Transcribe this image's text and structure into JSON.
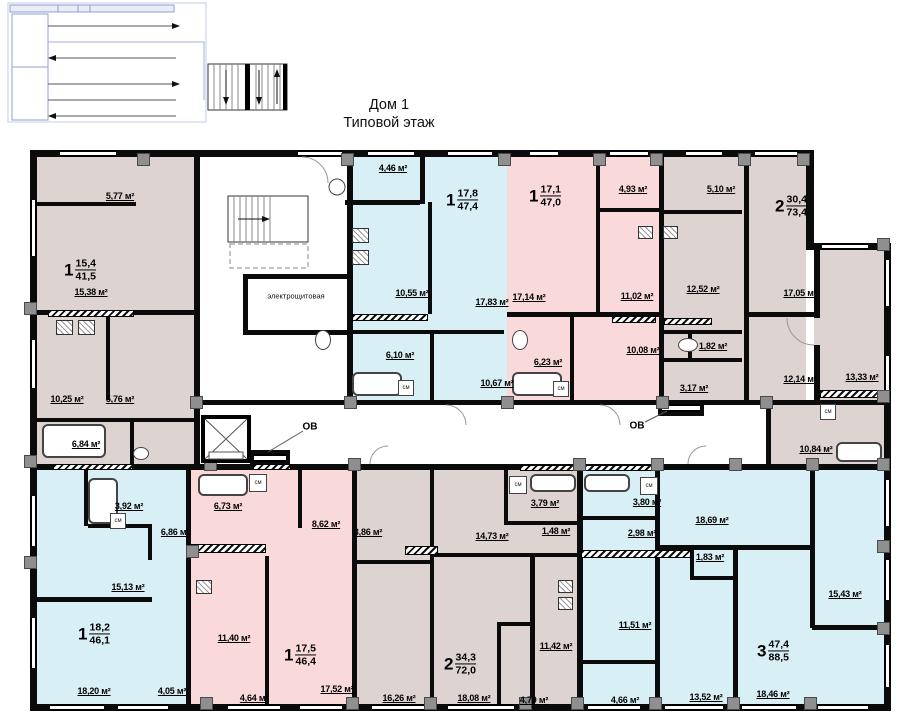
{
  "title": {
    "line1": "Дом 1",
    "line2": "Типовой этаж"
  },
  "colors": {
    "beige": "#ddd3d1",
    "pink": "#f9d9da",
    "blue": "#d9eff6",
    "wall": "#0b0b0b",
    "pilaster": "#8f8f8f",
    "schematic_line": "#8fa0cc"
  },
  "plan": {
    "rooms": [
      [
        36,
        156,
        158,
        308,
        "beige"
      ],
      [
        663,
        156,
        143,
        248,
        "beige"
      ],
      [
        814,
        250,
        70,
        156,
        "beige"
      ],
      [
        766,
        404,
        118,
        60,
        "beige"
      ],
      [
        356,
        470,
        222,
        234,
        "beige"
      ],
      [
        507,
        156,
        155,
        248,
        "pink"
      ],
      [
        188,
        470,
        167,
        234,
        "pink"
      ],
      [
        350,
        156,
        157,
        248,
        "blue"
      ],
      [
        36,
        470,
        152,
        234,
        "blue"
      ],
      [
        581,
        470,
        303,
        234,
        "blue"
      ]
    ],
    "ext_walls": [
      [
        30,
        150,
        783,
        7
      ],
      [
        30,
        150,
        7,
        561
      ],
      [
        30,
        704,
        861,
        7
      ],
      [
        884,
        243,
        7,
        468
      ],
      [
        806,
        150,
        8,
        100
      ],
      [
        806,
        243,
        85,
        7
      ]
    ],
    "walls": [
      [
        36,
        202,
        100,
        4
      ],
      [
        36,
        310,
        158,
        5
      ],
      [
        106,
        314,
        4,
        86
      ],
      [
        36,
        418,
        158,
        4
      ],
      [
        130,
        422,
        4,
        42
      ],
      [
        194,
        150,
        6,
        320
      ],
      [
        243,
        274,
        110,
        5
      ],
      [
        243,
        279,
        5,
        51
      ],
      [
        243,
        330,
        110,
        5
      ],
      [
        347,
        150,
        6,
        254
      ],
      [
        345,
        200,
        75,
        5
      ],
      [
        420,
        156,
        5,
        48
      ],
      [
        350,
        314,
        78,
        5
      ],
      [
        350,
        330,
        154,
        4
      ],
      [
        428,
        202,
        4,
        112
      ],
      [
        430,
        334,
        4,
        70
      ],
      [
        596,
        156,
        4,
        156
      ],
      [
        596,
        208,
        63,
        4
      ],
      [
        507,
        312,
        152,
        5
      ],
      [
        570,
        316,
        4,
        88
      ],
      [
        659,
        150,
        5,
        254
      ],
      [
        663,
        210,
        79,
        4
      ],
      [
        663,
        330,
        79,
        4
      ],
      [
        688,
        334,
        4,
        24
      ],
      [
        663,
        358,
        79,
        4
      ],
      [
        744,
        150,
        5,
        254
      ],
      [
        747,
        312,
        67,
        5
      ],
      [
        814,
        250,
        6,
        68
      ],
      [
        814,
        345,
        6,
        58
      ],
      [
        766,
        404,
        5,
        60
      ],
      [
        194,
        400,
        690,
        5
      ],
      [
        30,
        464,
        861,
        6
      ],
      [
        84,
        470,
        4,
        56
      ],
      [
        88,
        524,
        64,
        4
      ],
      [
        148,
        524,
        4,
        36
      ],
      [
        30,
        597,
        122,
        5
      ],
      [
        186,
        470,
        5,
        240
      ],
      [
        298,
        470,
        4,
        58
      ],
      [
        265,
        556,
        4,
        148
      ],
      [
        352,
        470,
        5,
        234
      ],
      [
        430,
        470,
        4,
        234
      ],
      [
        356,
        560,
        74,
        4
      ],
      [
        430,
        553,
        148,
        4
      ],
      [
        504,
        470,
        4,
        54
      ],
      [
        504,
        521,
        74,
        4
      ],
      [
        497,
        622,
        37,
        4
      ],
      [
        497,
        625,
        4,
        80
      ],
      [
        530,
        556,
        5,
        154
      ],
      [
        577,
        470,
        6,
        234
      ],
      [
        581,
        516,
        76,
        4
      ],
      [
        655,
        470,
        5,
        84
      ],
      [
        655,
        554,
        5,
        156
      ],
      [
        581,
        660,
        76,
        4
      ],
      [
        660,
        545,
        152,
        5
      ],
      [
        690,
        548,
        4,
        30
      ],
      [
        690,
        576,
        47,
        4
      ],
      [
        733,
        548,
        5,
        162
      ],
      [
        810,
        470,
        5,
        158
      ],
      [
        812,
        625,
        72,
        5
      ],
      [
        250,
        450,
        40,
        16
      ],
      [
        658,
        400,
        46,
        16
      ]
    ],
    "hatch": [
      [
        48,
        310,
        86,
        7
      ],
      [
        352,
        314,
        76,
        7
      ],
      [
        612,
        316,
        44,
        7
      ],
      [
        664,
        318,
        48,
        7
      ],
      [
        53,
        464,
        80,
        6
      ],
      [
        253,
        464,
        38,
        6
      ],
      [
        520,
        465,
        135,
        6
      ],
      [
        188,
        544,
        78,
        9
      ],
      [
        581,
        550,
        110,
        8
      ],
      [
        820,
        390,
        64,
        8
      ],
      [
        405,
        546,
        33,
        9
      ]
    ],
    "windows": [
      [
        60,
        150,
        56,
        7,
        "h"
      ],
      [
        298,
        150,
        44,
        7,
        "h"
      ],
      [
        368,
        150,
        46,
        7,
        "h"
      ],
      [
        448,
        150,
        44,
        7,
        "h"
      ],
      [
        530,
        150,
        28,
        7,
        "h"
      ],
      [
        610,
        150,
        38,
        7,
        "h"
      ],
      [
        686,
        150,
        36,
        7,
        "h"
      ],
      [
        755,
        150,
        42,
        7,
        "h"
      ],
      [
        822,
        243,
        46,
        7,
        "h"
      ],
      [
        50,
        704,
        54,
        7,
        "h"
      ],
      [
        118,
        704,
        50,
        7,
        "h"
      ],
      [
        228,
        704,
        52,
        7,
        "h"
      ],
      [
        300,
        704,
        42,
        7,
        "h"
      ],
      [
        372,
        704,
        54,
        7,
        "h"
      ],
      [
        448,
        704,
        66,
        7,
        "h"
      ],
      [
        588,
        704,
        52,
        7,
        "h"
      ],
      [
        665,
        704,
        58,
        7,
        "h"
      ],
      [
        742,
        704,
        54,
        7,
        "h"
      ],
      [
        818,
        704,
        50,
        7,
        "h"
      ],
      [
        30,
        200,
        7,
        56,
        "v"
      ],
      [
        30,
        340,
        7,
        48,
        "v"
      ],
      [
        30,
        496,
        7,
        50,
        "v"
      ],
      [
        30,
        618,
        7,
        50,
        "v"
      ],
      [
        884,
        260,
        7,
        46,
        "v"
      ],
      [
        884,
        356,
        7,
        40,
        "v"
      ],
      [
        884,
        480,
        7,
        46,
        "v"
      ],
      [
        884,
        560,
        7,
        40,
        "v"
      ],
      [
        884,
        645,
        7,
        42,
        "v"
      ],
      [
        254,
        454,
        32,
        8,
        "h"
      ],
      [
        662,
        404,
        38,
        8,
        "h"
      ]
    ],
    "pilasters": [
      [
        137,
        153
      ],
      [
        341,
        153
      ],
      [
        498,
        153
      ],
      [
        593,
        153
      ],
      [
        650,
        153
      ],
      [
        738,
        153
      ],
      [
        797,
        153
      ],
      [
        200,
        697
      ],
      [
        346,
        697
      ],
      [
        424,
        697
      ],
      [
        519,
        697
      ],
      [
        571,
        697
      ],
      [
        649,
        697
      ],
      [
        727,
        697
      ],
      [
        804,
        697
      ],
      [
        24,
        302
      ],
      [
        24,
        455
      ],
      [
        24,
        556
      ],
      [
        877,
        238
      ],
      [
        877,
        390
      ],
      [
        877,
        458
      ],
      [
        877,
        540
      ],
      [
        877,
        622
      ],
      [
        190,
        396
      ],
      [
        344,
        396
      ],
      [
        501,
        396
      ],
      [
        656,
        396
      ],
      [
        760,
        396
      ],
      [
        204,
        458
      ],
      [
        348,
        458
      ],
      [
        573,
        458
      ],
      [
        651,
        458
      ],
      [
        729,
        458
      ],
      [
        806,
        458
      ],
      [
        186,
        545
      ]
    ],
    "tubs": [
      [
        42,
        424,
        64,
        34
      ],
      [
        352,
        372,
        50,
        24
      ],
      [
        512,
        372,
        50,
        24
      ],
      [
        836,
        442,
        46,
        20
      ],
      [
        88,
        478,
        30,
        46
      ],
      [
        198,
        474,
        50,
        22
      ],
      [
        530,
        474,
        46,
        18
      ],
      [
        584,
        474,
        46,
        18
      ]
    ],
    "stoves": [
      [
        56,
        320,
        17,
        15
      ],
      [
        78,
        320,
        17,
        15
      ],
      [
        352,
        228,
        17,
        15
      ],
      [
        352,
        250,
        17,
        15
      ],
      [
        638,
        226,
        15,
        13
      ],
      [
        663,
        226,
        15,
        13
      ],
      [
        196,
        580,
        16,
        14
      ],
      [
        558,
        580,
        15,
        13
      ],
      [
        558,
        597,
        15,
        13
      ]
    ],
    "toilets": [
      [
        315,
        330,
        16,
        20
      ],
      [
        512,
        330,
        16,
        20
      ],
      [
        678,
        338,
        20,
        14
      ],
      [
        133,
        447,
        16,
        13
      ]
    ],
    "cm_label": "см",
    "cm_boxes": [
      [
        249,
        474,
        18,
        18
      ],
      [
        398,
        380,
        16,
        16
      ],
      [
        553,
        381,
        16,
        16
      ],
      [
        820,
        404,
        16,
        16
      ],
      [
        509,
        476,
        18,
        18
      ],
      [
        640,
        477,
        18,
        18
      ],
      [
        110,
        513,
        16,
        16
      ]
    ],
    "area_labels": [
      [
        120,
        196,
        "5,77 м²"
      ],
      [
        91,
        292,
        "15,38 м²"
      ],
      [
        67,
        399,
        "10,25 м²"
      ],
      [
        120,
        399,
        "5,76 м²"
      ],
      [
        86,
        444,
        "6,84 м²"
      ],
      [
        393,
        168,
        "4,46 м²"
      ],
      [
        412,
        293,
        "10,55 м²"
      ],
      [
        492,
        302,
        "17,83 м²"
      ],
      [
        400,
        355,
        "6,10 м²"
      ],
      [
        497,
        383,
        "10,67 м²"
      ],
      [
        529,
        297,
        "17,14 м²"
      ],
      [
        548,
        362,
        "6,23 м²"
      ],
      [
        633,
        189,
        "4,93 м²"
      ],
      [
        637,
        296,
        "11,02 м²"
      ],
      [
        643,
        350,
        "10,08 м²"
      ],
      [
        721,
        189,
        "5,10 м²"
      ],
      [
        703,
        289,
        "12,52 м²"
      ],
      [
        713,
        346,
        "1,82 м²"
      ],
      [
        694,
        388,
        "3,17 м²"
      ],
      [
        800,
        293,
        "17,05 м²"
      ],
      [
        800,
        379,
        "12,14 м²"
      ],
      [
        862,
        377,
        "13,33 м²"
      ],
      [
        816,
        449,
        "10,84 м²"
      ],
      [
        129,
        506,
        "3,92 м²"
      ],
      [
        175,
        532,
        "6,86 м²"
      ],
      [
        128,
        587,
        "15,13 м²"
      ],
      [
        94,
        691,
        "18,20 м²"
      ],
      [
        172,
        691,
        "4,05 м²"
      ],
      [
        228,
        506,
        "6,73 м²"
      ],
      [
        326,
        524,
        "8,62 м²"
      ],
      [
        234,
        638,
        "11,40 м²"
      ],
      [
        254,
        698,
        "4,64 м²"
      ],
      [
        337,
        689,
        "17,52 м²"
      ],
      [
        368,
        532,
        "3,86 м²"
      ],
      [
        492,
        536,
        "14,73 м²"
      ],
      [
        399,
        698,
        "16,26 м²"
      ],
      [
        474,
        698,
        "18,08 м²"
      ],
      [
        534,
        700,
        "4,79 м²"
      ],
      [
        545,
        503,
        "3,79 м²"
      ],
      [
        556,
        531,
        "1,48 м²"
      ],
      [
        556,
        646,
        "11,42 м²"
      ],
      [
        647,
        502,
        "3,80 м²"
      ],
      [
        642,
        533,
        "2,98 м²"
      ],
      [
        635,
        625,
        "11,51 м²"
      ],
      [
        625,
        700,
        "4,66 м²"
      ],
      [
        712,
        520,
        "18,69 м²"
      ],
      [
        710,
        557,
        "1,83 м²"
      ],
      [
        706,
        697,
        "13,52 м²"
      ],
      [
        773,
        694,
        "18,46 м²"
      ],
      [
        845,
        594,
        "15,43 м²"
      ]
    ],
    "apartments": [
      [
        80,
        270,
        "1",
        "15,4",
        "41,5"
      ],
      [
        462,
        200,
        "1",
        "17,8",
        "47,4"
      ],
      [
        545,
        196,
        "1",
        "17,1",
        "47,0"
      ],
      [
        791,
        206,
        "2",
        "30,4",
        "73,4"
      ],
      [
        94,
        634,
        "1",
        "18,2",
        "46,1"
      ],
      [
        300,
        655,
        "1",
        "17,5",
        "46,4"
      ],
      [
        460,
        664,
        "2",
        "34,3",
        "72,0"
      ],
      [
        773,
        651,
        "3",
        "47,4",
        "88,5"
      ]
    ],
    "room_names": [
      [
        296,
        296,
        "электрощитовая"
      ]
    ],
    "ducts": [
      [
        310,
        427,
        "ОВ"
      ],
      [
        637,
        426,
        "ОВ"
      ]
    ]
  }
}
